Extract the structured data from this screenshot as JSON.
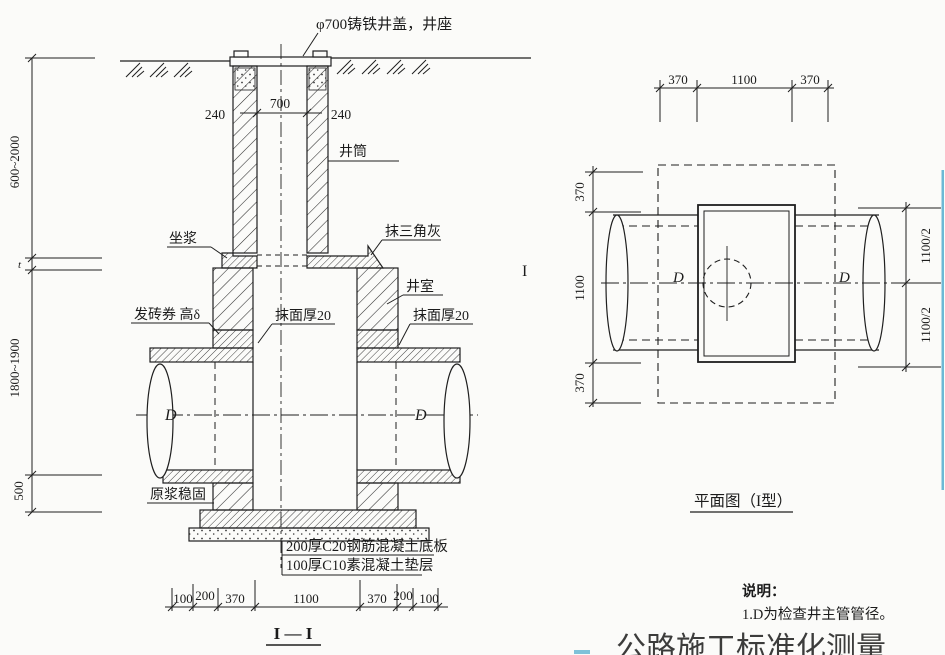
{
  "section": {
    "cover_label": "φ700铸铁井盖，井座",
    "shaft_label": "井筒",
    "mortar_label": "坐浆",
    "fillet_label": "抹三角灰",
    "chamber_label": "井室",
    "arch_label": "发砖券 高δ",
    "plaster_left_label": "抹面厚20",
    "plaster_right_label": "抹面厚20",
    "grout_label": "原浆稳固",
    "slab_label": "200厚C20钢筋混凝土底板",
    "cushion_label": "100厚C10素混凝土垫层",
    "pipe_d_left": "D",
    "pipe_d_right": "D",
    "marker": "I",
    "title": "I — I",
    "dim_240_left": "240",
    "dim_700": "700",
    "dim_240_right": "240",
    "dim_v1": "600~2000",
    "dim_vt": "t",
    "dim_v2": "1800~1900",
    "dim_v3": "500",
    "dims_bottom": [
      "100",
      "200",
      "370",
      "1100",
      "370",
      "200",
      "100"
    ]
  },
  "plan": {
    "title": "平面图（I型）",
    "dim_top_1": "370",
    "dim_top_2": "1100",
    "dim_top_3": "370",
    "dim_left_1": "370",
    "dim_left_2": "1100",
    "dim_left_3": "370",
    "dim_right_1": "1100/2",
    "dim_right_2": "1100/2",
    "d_left": "D",
    "d_right": "D"
  },
  "notes": {
    "heading": "说明：",
    "item_1": "1.D为检查井主管管径。"
  },
  "watermark": "公路施工标准化测量",
  "colors": {
    "ink": "#1f1f1f",
    "artifact_blue": "#4aa9cc",
    "watermark_gray": "#87878f"
  }
}
